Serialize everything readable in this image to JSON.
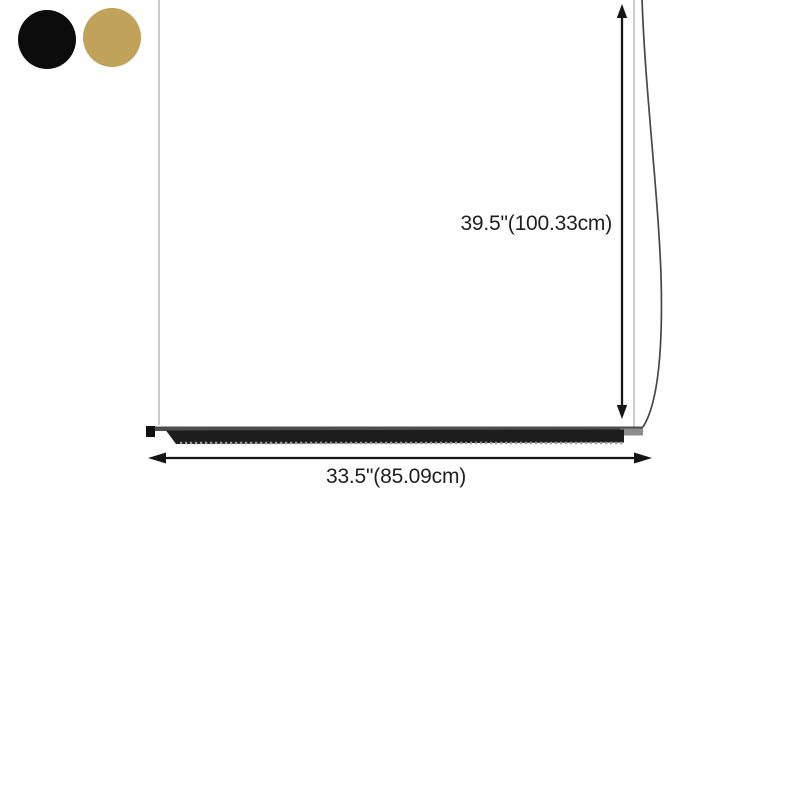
{
  "color_options": {
    "swatches": [
      {
        "name": "black",
        "color": "#0c0c0c"
      },
      {
        "name": "gold",
        "color": "#c1a25b"
      }
    ]
  },
  "dimensions": {
    "height_label": "39.5\"(100.33cm)",
    "width_label": "33.5\"(85.09cm)",
    "arrow_color": "#161616"
  },
  "fixture": {
    "cable_color": "#b7b7b7",
    "cord_color": "#474747",
    "rail_color": "#4e4e4e",
    "bar_color": "#1d1d1d",
    "endcap_color": "#101010",
    "connector_color": "#8c8c8c",
    "diffuser_dot_color": "#9b9b9b"
  }
}
